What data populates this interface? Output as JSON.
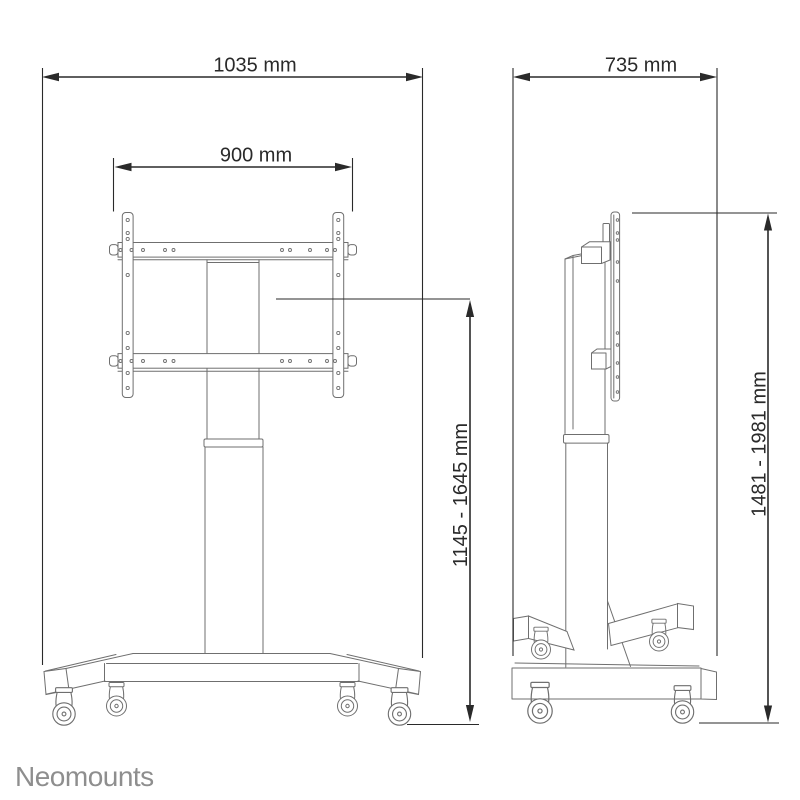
{
  "branding": {
    "logo_text": "Neomounts"
  },
  "colors": {
    "product_line": "#6f6f6f",
    "dimension_line": "#2a2a2a",
    "logo": "#8e8e8e",
    "background": "#ffffff"
  },
  "front_view": {
    "dim_total_width": "1035 mm",
    "dim_vesa_width": "900 mm",
    "dim_lift_height": "1145 - 1645 mm"
  },
  "side_view": {
    "dim_depth": "735 mm",
    "dim_total_height": "1481 - 1981 mm"
  }
}
